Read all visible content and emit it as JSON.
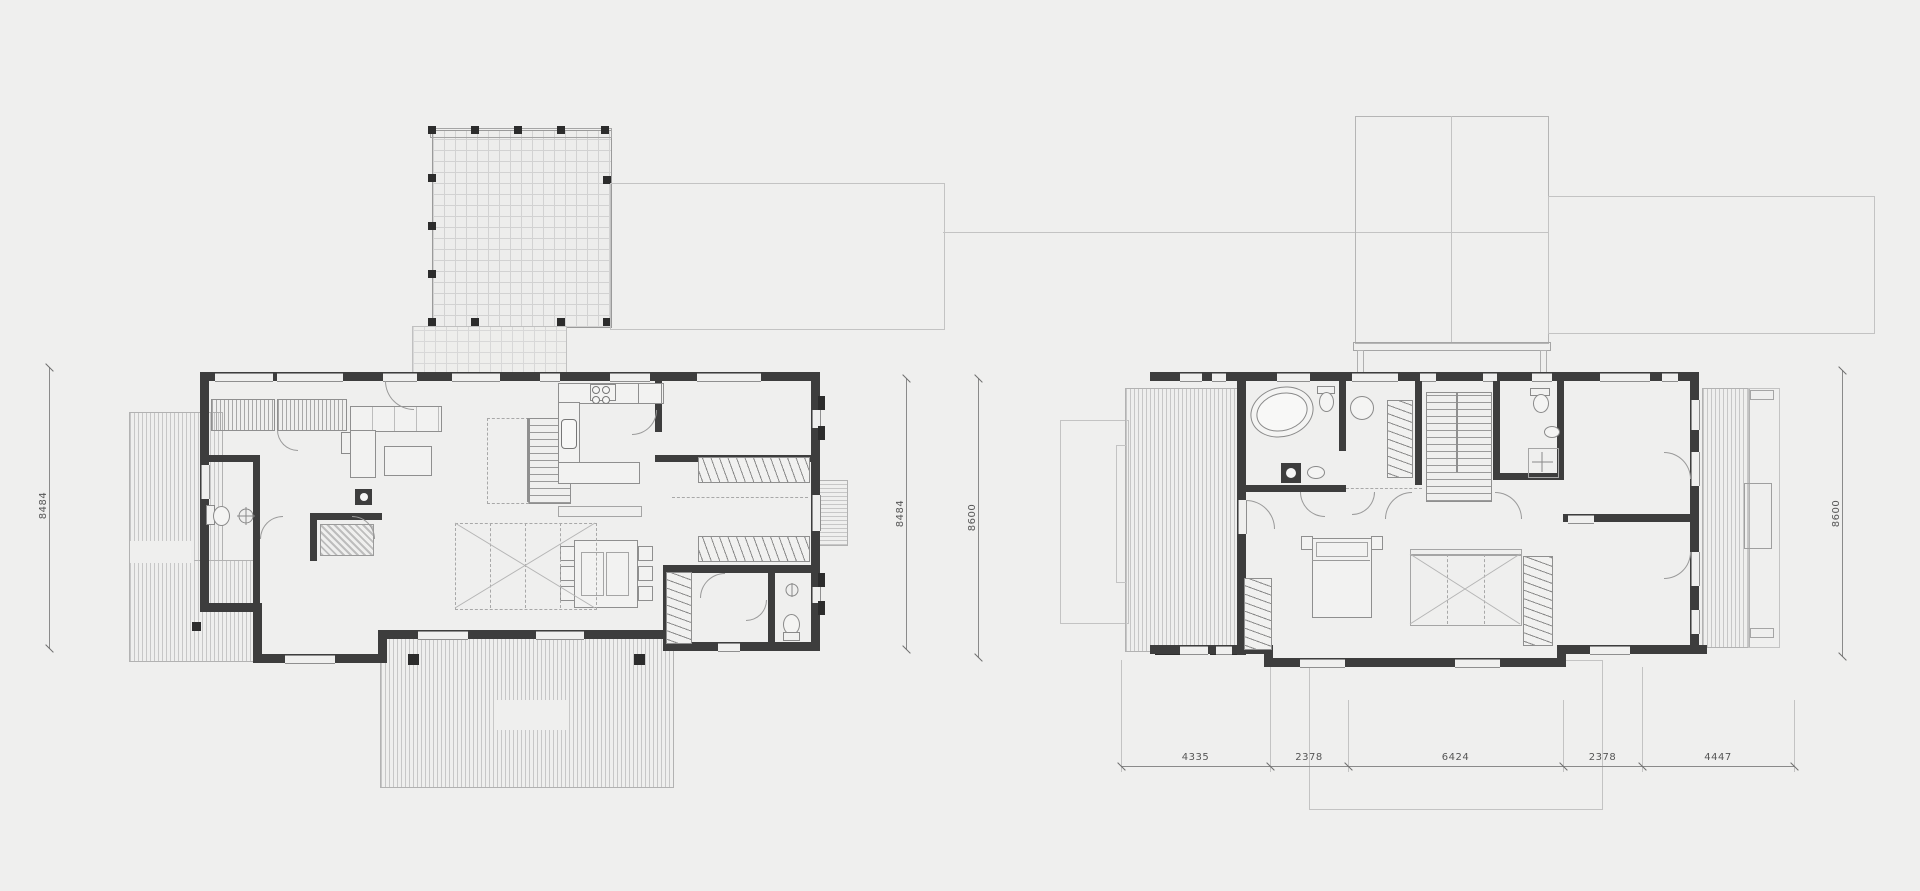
{
  "drawing": {
    "type": "architectural floor plans, two storeys side by side",
    "colors": {
      "background": "#efefee",
      "wall": "#3d3d3d",
      "post": "#2c2c2c",
      "line": "#8f8f8f",
      "faint_line": "#c3c3c3",
      "deck_stripe": "#c7c7c7",
      "dimension_text": "#565656"
    }
  },
  "ground_floor": {
    "dim_left": "8484"
  },
  "between_plans": {
    "dim_inner": "8484",
    "dim_outer": "8600"
  },
  "upper_floor": {
    "dim_right": "8600",
    "dim_bottom": [
      "4335",
      "2378",
      "6424",
      "2378",
      "4447"
    ]
  }
}
